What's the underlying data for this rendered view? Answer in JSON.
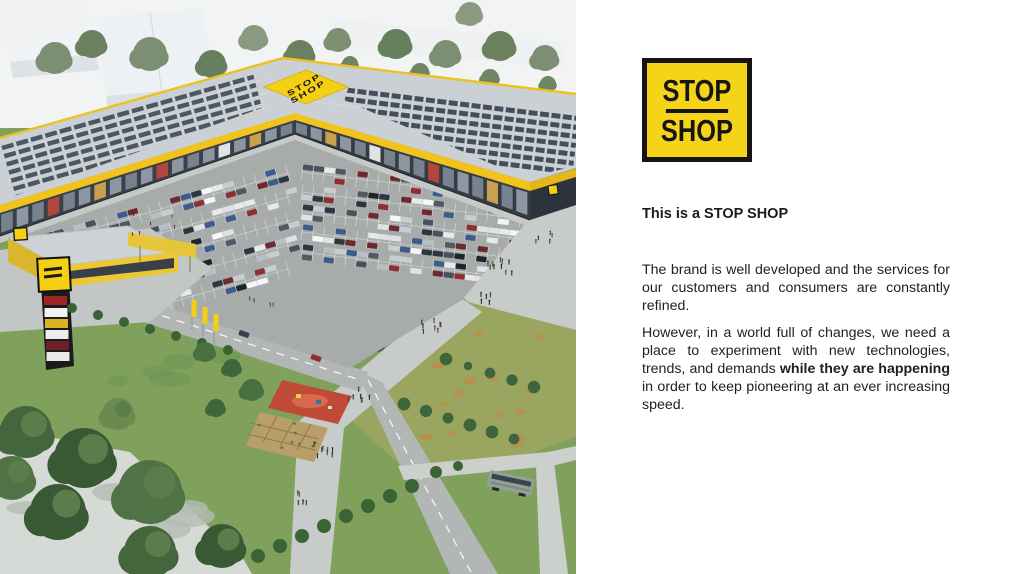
{
  "slide": {
    "logo": {
      "top": "STOP",
      "bottom": "SHOP"
    },
    "heading": "This is a STOP SHOP",
    "paragraph1": "The brand is well developed and the services for our customers and consumers are constantly refined.",
    "paragraph2": {
      "before": "However, in a world full of changes, we need a place to experiment with new technologies, trends, and demands ",
      "bold": "while they are happening",
      "after": " in order to keep pioneering at an ever increasing speed."
    }
  },
  "image": {
    "description": "Aerial 3D rendering of a STOP SHOP retail park: L-shaped building with yellow fascia and rooftop solar panels, rooftop diamond logo, large car park with cars, access roads, pylon sign, small yellow pavilion, playground, meadows, trees and a bus stop",
    "roof_logo": {
      "line1": "STOP",
      "line2": "SHOP"
    },
    "colors": {
      "brand_yellow": "#F5CF14",
      "logo_black": "#151515"
    }
  }
}
